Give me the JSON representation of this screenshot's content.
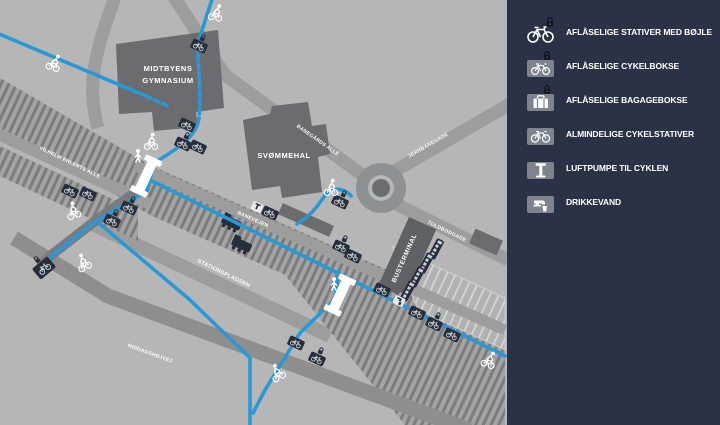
{
  "legend": {
    "background": "#2b3245",
    "items": [
      {
        "icon": "locked-hoop-bike-stand-icon",
        "label": "AFLÅSELIGE STATIVER MED BØJLE"
      },
      {
        "icon": "locked-bike-box-icon",
        "label": "AFLÅSELIGE CYKELBOKSE"
      },
      {
        "icon": "locked-luggage-box-icon",
        "label": "AFLÅSELIGE BAGAGEBOKSE"
      },
      {
        "icon": "bike-stand-icon",
        "label": "ALMINDELIGE CYKELSTATIVER"
      },
      {
        "icon": "bike-pump-icon",
        "label": "LUFTPUMPE TIL CYKLEN"
      },
      {
        "icon": "drinking-water-icon",
        "label": "DRIKKEVAND"
      }
    ]
  },
  "map": {
    "buildings": {
      "gymnasium": {
        "line1": "MIDTBYENS",
        "line2": "GYMNASIUM"
      },
      "svommehal": {
        "label": "SVØMMEHAL"
      },
      "busterminal": {
        "label": "BUSTERMINAL"
      }
    },
    "streets": {
      "vilhelm": "VILHELM EHLERTS ALLE",
      "banevejen": "BANEVEJEN",
      "banegaards": "BANEGÅRDS ALLÉ",
      "jernbanegade": "JERNBANEGADE",
      "toldbodgade": "TOLDBODGADE",
      "stationspladsen": "STATIONSPLADSEN",
      "middagshojvej": "MIDDAGSHØJVEJ"
    },
    "colors": {
      "background": "#b6b6b6",
      "road": "#9d9d9d",
      "road_dark": "#8e8e8e",
      "building": "#6c6c6e",
      "rail_tie": "#7c7c7c",
      "cycle_path": "#2899d6",
      "marker_dark": "#262d3b",
      "legend_bg": "#2b3245",
      "legend_tile": "#7e838d"
    }
  }
}
